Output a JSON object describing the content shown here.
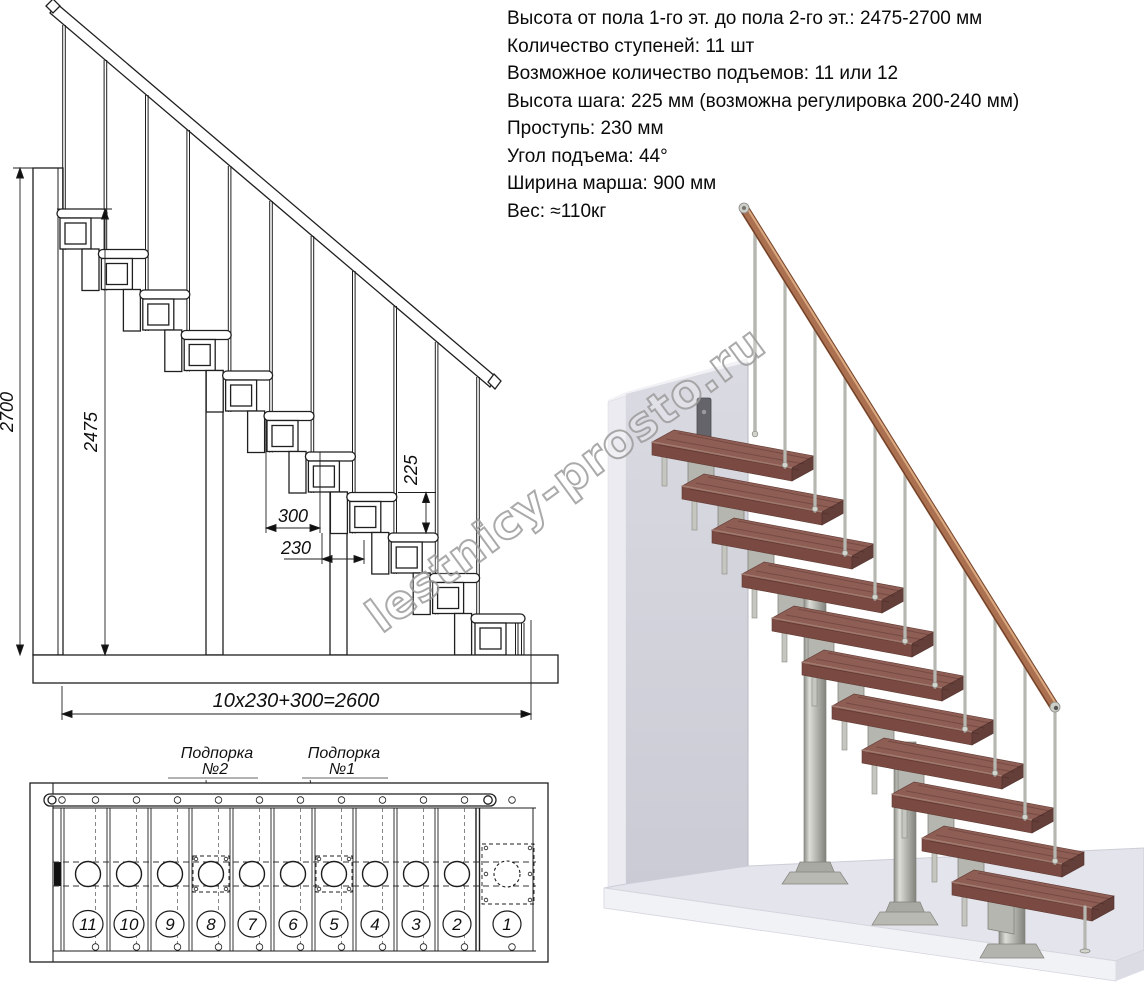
{
  "specs": {
    "lines": [
      "Высота от пола 1-го эт. до пола 2-го эт.: 2475-2700 мм",
      "Количество ступеней: 11 шт",
      "Возможное количество подъемов: 11 или 12",
      "Высота шага: 225 мм (возможна регулировка 200-240 мм)",
      "Проступь: 230 мм",
      "Угол подъема: 44°",
      "Ширина марша: 900 мм",
      "Вес: ≈110кг"
    ]
  },
  "side_view": {
    "dims": {
      "total_height": "2700",
      "flight_height": "2475",
      "step_rise": "225",
      "tread_depth": "300",
      "step_run": "230",
      "total_run": "10x230+300=2600"
    }
  },
  "plan_view": {
    "support2": {
      "line1": "Подпорка",
      "line2": "№2"
    },
    "support1": {
      "line1": "Подпорка",
      "line2": "№1"
    },
    "step_numbers": [
      "11",
      "10",
      "9",
      "8",
      "7",
      "6",
      "5",
      "4",
      "3",
      "2",
      "1"
    ]
  },
  "watermark": {
    "text": "lestnicy-prosto.ru"
  },
  "colors": {
    "wood_top": "#8e5e55",
    "wood_front": "#7a4a42",
    "metal": "#b6b6b0",
    "handrail": "#aa7050",
    "wall": "#d5d5de",
    "floor": "#e4e4ec",
    "line": "#1f1f1f",
    "watermark_gray": "#9c9c9c"
  }
}
